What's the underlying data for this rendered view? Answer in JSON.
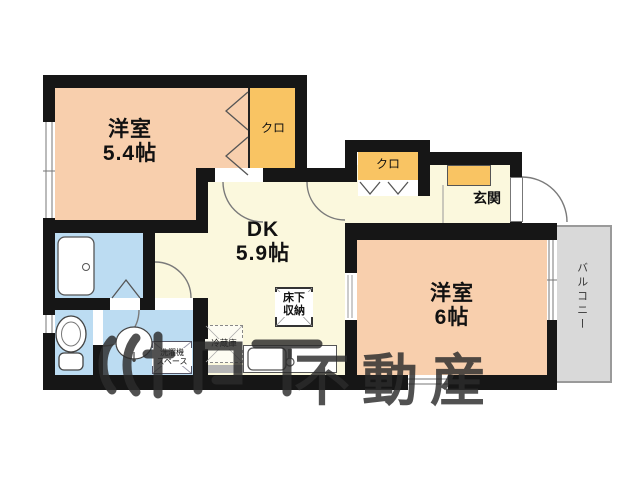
{
  "plan_title": "apartment-floor-plan",
  "rooms": {
    "west1": {
      "name": "洋室",
      "size": "5.4帖"
    },
    "dk": {
      "name": "DK",
      "size": "5.9帖"
    },
    "west2": {
      "name": "洋室",
      "size": "6帖"
    },
    "entrance": {
      "label": "玄関"
    },
    "balcony": {
      "label": "バルコニー"
    },
    "closet1": {
      "label": "クロ"
    },
    "closet2": {
      "label": "クロ"
    },
    "underfloor": {
      "line1": "床下",
      "line2": "収納"
    },
    "fridge": {
      "label": "冷蔵庫"
    },
    "washer": {
      "line1": "洗濯機",
      "line2": "スペース"
    }
  },
  "watermark": {
    "text": "不動産"
  },
  "colors": {
    "room": "#f8cfad",
    "closet": "#f9c463",
    "living": "#fbf8dd",
    "wet": "#bcdcf2",
    "wall": "#161616",
    "balcony": "#d9d9d9",
    "arc": "#7a7a7a"
  }
}
